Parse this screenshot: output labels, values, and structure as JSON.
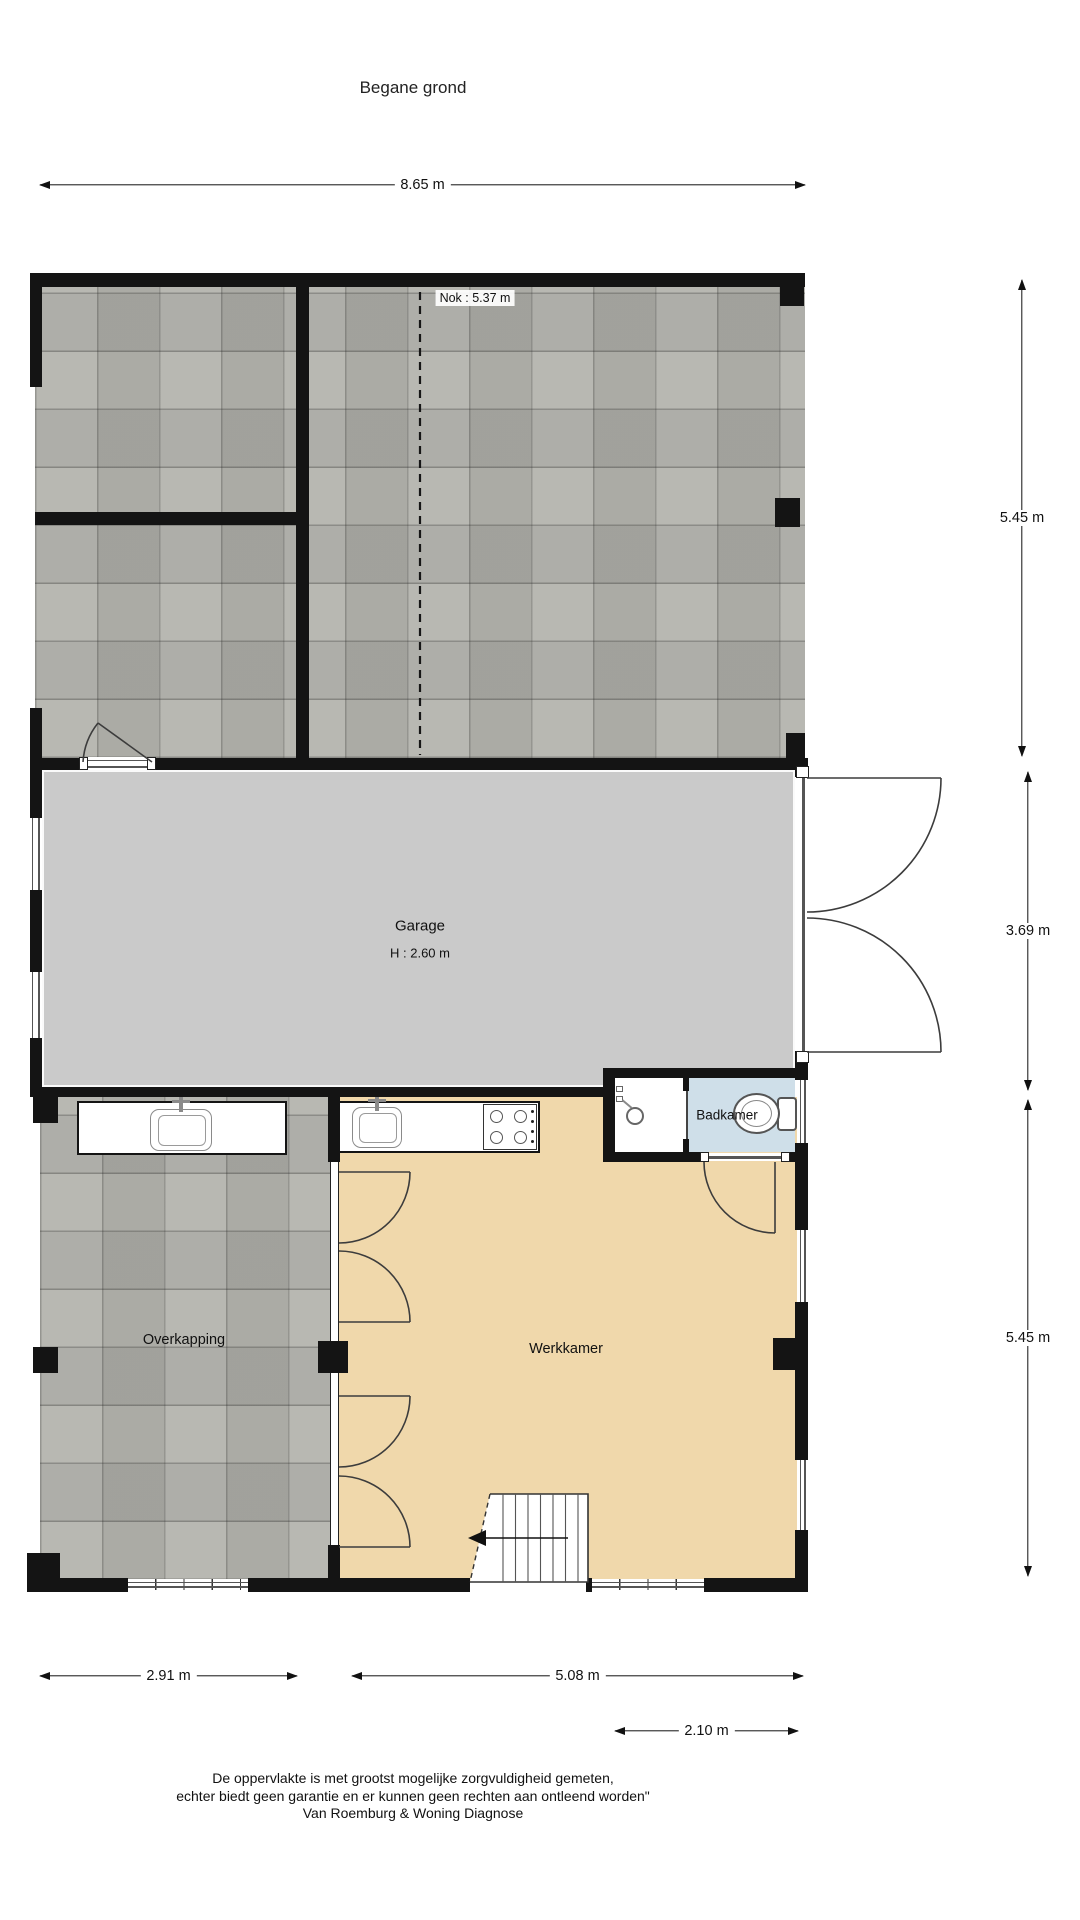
{
  "title": "Begane grond",
  "rooms": {
    "garage": {
      "label": "Garage",
      "height": "H : 2.60 m"
    },
    "badkamer": {
      "label": "Badkamer"
    },
    "overkapping": {
      "label": "Overkapping"
    },
    "werkkamer": {
      "label": "Werkkamer"
    }
  },
  "annotations": {
    "nok": "Nok : 5.37 m"
  },
  "dimensions": {
    "top": "8.65 m",
    "right_upper": "5.45 m",
    "right_middle": "3.69 m",
    "right_lower": "5.45 m",
    "bottom_left": "2.91 m",
    "bottom_middle": "5.08 m",
    "bottom_right": "2.10 m"
  },
  "footer": {
    "line1": "De oppervlakte is met grootst mogelijke zorgvuldigheid gemeten,",
    "line2": "echter biedt geen garantie en er kunnen geen rechten aan ontleend worden\"",
    "line3": "Van Roemburg & Woning Diagnose"
  },
  "colors": {
    "wall": "#141414",
    "tile": "#b1b1ab",
    "garage_floor": "#cacaca",
    "werkkamer_floor": "#f0d8ab",
    "badkamer_floor": "#cfdfe9"
  }
}
